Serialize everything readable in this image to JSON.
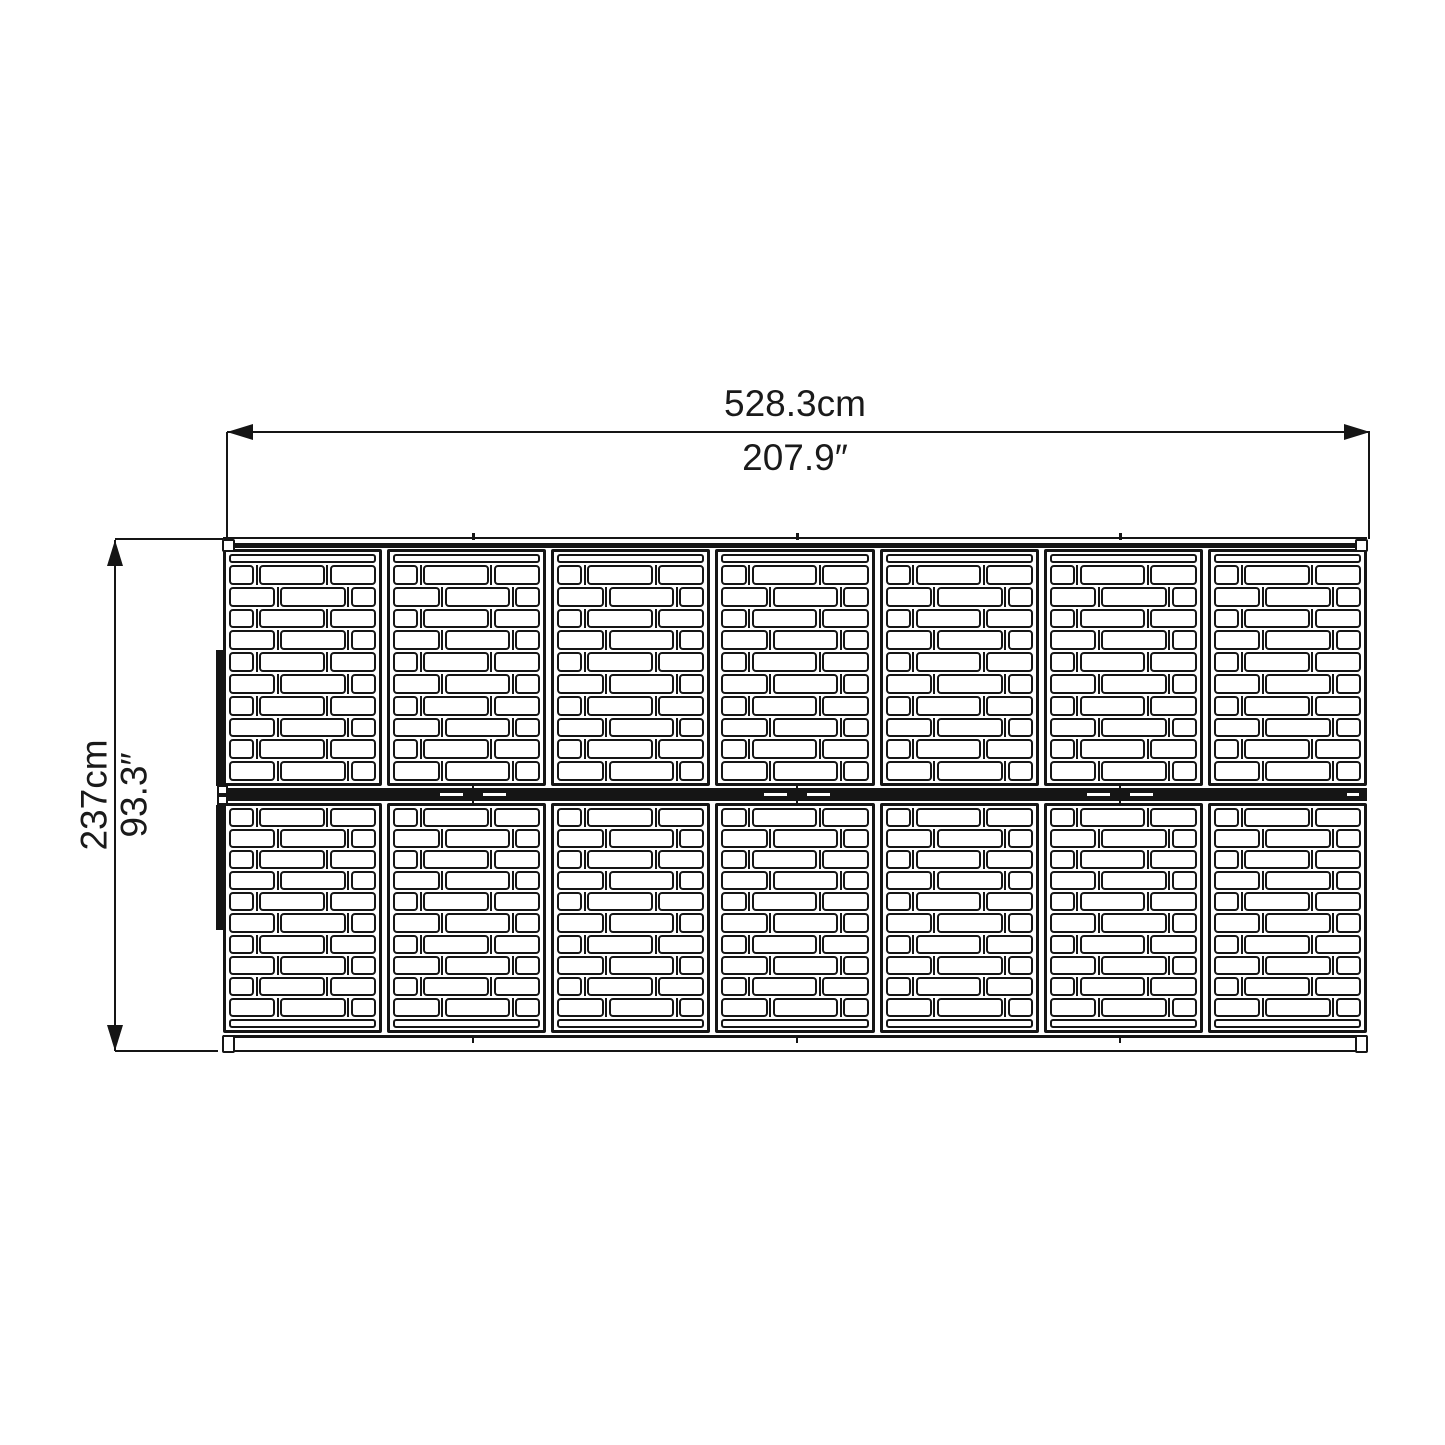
{
  "title": "panel-structure-dimension-drawing",
  "dimensions": {
    "width_metric": "528.3cm",
    "width_imperial": "207.9″",
    "height_metric": "237cm",
    "height_imperial": "93.3″"
  },
  "structure": {
    "panel_columns": 7,
    "panel_bands": 2,
    "brick_rows_per_panel": 10,
    "brick_pattern_odd": [
      1,
      2.9,
      2
    ],
    "brick_pattern_even": [
      2,
      2.9,
      1
    ],
    "section_joint_x_px": [
      473,
      797,
      1120
    ],
    "structure_left_px": 223,
    "line_color": "#151515",
    "background_color": "#ffffff"
  }
}
